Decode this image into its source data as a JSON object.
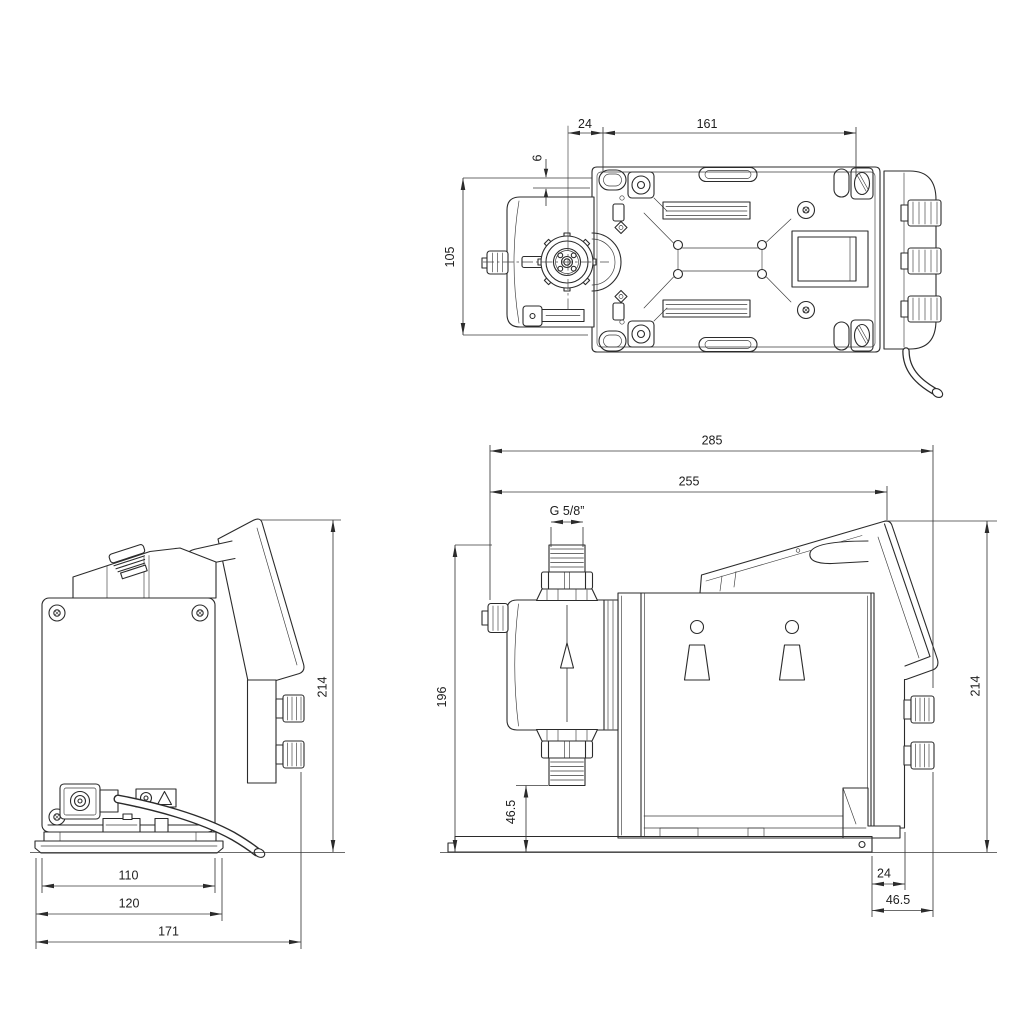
{
  "page": {
    "background": "#ffffff",
    "ink": "#2b2b2b"
  },
  "views": {
    "top": {
      "name": "top-view",
      "dims": {
        "d24": "24",
        "d161": "161",
        "d6": "6",
        "d105": "105"
      }
    },
    "back": {
      "name": "back-view",
      "dims": {
        "d214": "214",
        "d110": "110",
        "d120": "120",
        "d171": "171"
      }
    },
    "side": {
      "name": "side-view",
      "dims": {
        "d285": "285",
        "d255": "255",
        "thread": "G 5/8”",
        "d196": "196",
        "d46_5_valve": "46.5",
        "d214": "214",
        "d24": "24",
        "d46_5": "46.5"
      }
    }
  }
}
